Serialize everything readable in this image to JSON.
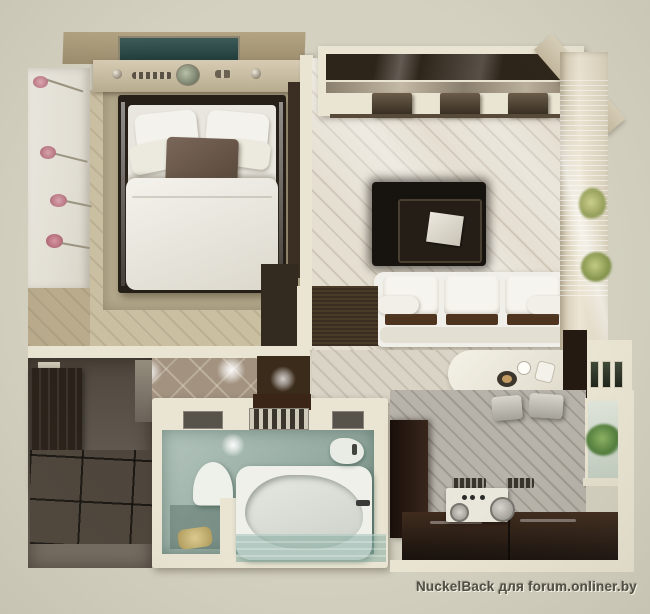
{
  "watermark": {
    "text": "NuckelBack для forum.onliner.by"
  },
  "palette": {
    "background": "#d4d1c1",
    "wall": "#eae5d3",
    "bedroom_floor": "#cbbfa2",
    "bedroom_carpet": "#b5aa8d",
    "bed_frame": "#261f18",
    "bedding": "#e9e6df",
    "accent_pillow": "#6e5b4a",
    "living_floor": "#e5dfd2",
    "wall_unit_dark": "#2e251a",
    "rug_black": "#17130f",
    "sofa_white": "#f1efe9",
    "curtain_wall": "#e2dac6",
    "hall_floor": "#a2927f",
    "entry_dark": "#5a5248",
    "wardrobe_dark": "#2a221a",
    "bathroom_teal": "#9fb5aa",
    "tub_white": "#eff0ea",
    "kitchen_floor": "#b7b3aa",
    "kitchen_cabinet": "#2c2017",
    "flower_pink": "#d9a3ad",
    "plant_green": "#a9b464",
    "tv_panel_teal": "#31504e"
  },
  "scene": {
    "type": "apartment-floor-plan-3d-top-view",
    "rooms": [
      "bedroom",
      "living-room",
      "hallway",
      "entry",
      "bathroom",
      "kitchen"
    ],
    "objects": [
      "double-bed",
      "flower-wall-mural",
      "wall-unit",
      "black-rug",
      "coffee-table",
      "white-sofa",
      "curved-dining-table",
      "chairs",
      "window-curtains",
      "plants",
      "spotlights",
      "wardrobe",
      "bathtub",
      "toilet-nook",
      "sink",
      "kitchen-cabinets",
      "stove",
      "bar-stools",
      "kitchen-window"
    ]
  }
}
